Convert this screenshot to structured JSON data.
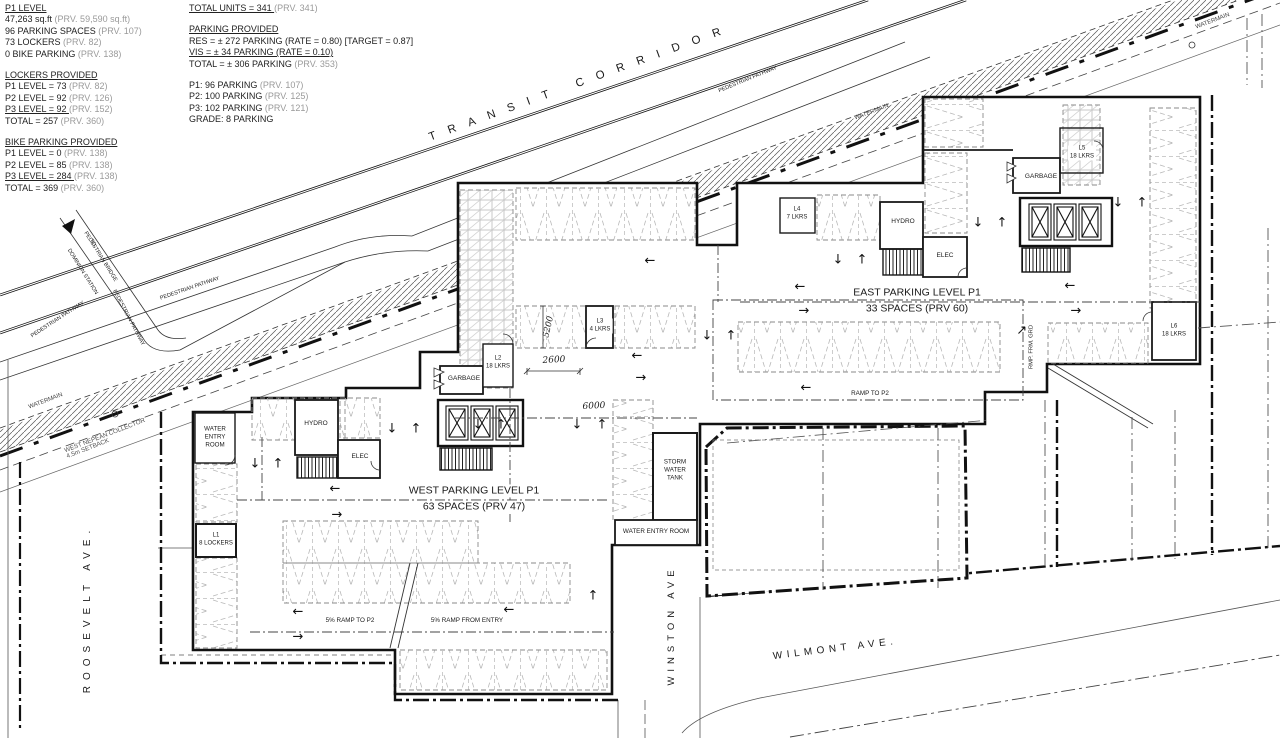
{
  "title_blocks": {
    "left": {
      "lines": [
        {
          "m": "P1 LEVEL",
          "u": true
        },
        {
          "m": "47,263 sq.ft ",
          "p": "(PRV. 59,590 sq.ft)"
        },
        {
          "m": "96 PARKING SPACES ",
          "p": "(PRV. 107)"
        },
        {
          "m": "73 LOCKERS ",
          "p": "(PRV. 82)"
        },
        {
          "m": "0 BIKE PARKING ",
          "p": "(PRV. 138)"
        },
        {
          "gap": true
        },
        {
          "m": "LOCKERS PROVIDED",
          "u": true
        },
        {
          "m": "P1 LEVEL = 73 ",
          "p": "(PRV. 82)"
        },
        {
          "m": "P2 LEVEL = 92 ",
          "p": "(PRV. 126)"
        },
        {
          "m": "P3 LEVEL = 92 ",
          "p": "(PRV. 152)",
          "u": true
        },
        {
          "m": "TOTAL = 257 ",
          "p": "(PRV. 360)"
        },
        {
          "gap": true
        },
        {
          "m": "BIKE PARKING PROVIDED",
          "u": true
        },
        {
          "m": "P1 LEVEL = 0 ",
          "p": "(PRV. 138)"
        },
        {
          "m": "P2 LEVEL = 85 ",
          "p": "(PRV. 138)"
        },
        {
          "m": "P3 LEVEL = 284 ",
          "p": "(PRV. 138)",
          "u": true
        },
        {
          "m": "TOTAL = 369 ",
          "p": "(PRV. 360)"
        }
      ]
    },
    "right": {
      "lines": [
        {
          "m": "TOTAL UNITS = 341 ",
          "p": "(PRV. 341)",
          "u": true
        },
        {
          "gap": true
        },
        {
          "m": "PARKING PROVIDED",
          "u": true
        },
        {
          "m": "RES = ± 272 PARKING (RATE = 0.80) [TARGET = 0.87]"
        },
        {
          "m": "VIS  =  ± 34  PARKING (RATE = 0.10)",
          "u": true
        },
        {
          "m": "TOTAL =  ± 306 PARKING ",
          "p": "(PRV. 353)"
        },
        {
          "gap": true
        },
        {
          "m": "P1: 96 PARKING ",
          "p": "(PRV. 107)"
        },
        {
          "m": "P2: 100 PARKING ",
          "p": "(PRV. 125)"
        },
        {
          "m": "P3: 102 PARKING ",
          "p": "(PRV. 121)"
        },
        {
          "m": "GRADE: 8 PARKING"
        }
      ]
    }
  },
  "plan": {
    "labels": [
      {
        "id": "transit-corridor-label",
        "t": "TRANSIT  CORRIDOR",
        "x": 575,
        "y": 85,
        "rot": -20,
        "fs": 11.5,
        "ls": 13
      },
      {
        "id": "pedestrian-pathway-label-1",
        "t": "PEDESTRIAN PATHWAY",
        "x": 190,
        "y": 289,
        "rot": -19,
        "fs": 5.5
      },
      {
        "id": "pedestrian-pathway-label-2",
        "t": "PEDESTRIAN PATHWAY",
        "x": 748,
        "y": 80,
        "rot": -22,
        "fs": 5.5
      },
      {
        "id": "pedestrian-pathway-label-3",
        "t": "PEDESTRIAN PATHWAY",
        "x": 128,
        "y": 318,
        "rot": 62,
        "fs": 5.5
      },
      {
        "id": "pedestrian-pathway-label-4",
        "t": "PEDESTRIAN PATHWAY",
        "x": 58,
        "y": 320,
        "rot": -33,
        "fs": 5.5
      },
      {
        "id": "pedestrian-bridge-label",
        "t": "PEDESTRIAN BRIDGE",
        "x": 100,
        "y": 257,
        "rot": 58,
        "fs": 5.5
      },
      {
        "id": "bridge-to-label",
        "t": "TO",
        "x": 92,
        "y": 243,
        "rot": 58,
        "fs": 5.5
      },
      {
        "id": "dominion-station-label",
        "t": "DOMINION STATION",
        "x": 82,
        "y": 272,
        "rot": 58,
        "fs": 5.5
      },
      {
        "id": "watermain-label-1",
        "t": "WATERMAIN",
        "x": 46,
        "y": 402,
        "rot": -21,
        "fs": 6,
        "c": "#444"
      },
      {
        "id": "watermain-label-2",
        "t": "WATERMAIN",
        "x": 872,
        "y": 113,
        "rot": -21,
        "fs": 6,
        "c": "#444"
      },
      {
        "id": "watermain-label-3",
        "t": "WATERMAIN",
        "x": 1213,
        "y": 22,
        "rot": -21,
        "fs": 6,
        "c": "#444"
      },
      {
        "id": "west-nepean-collector-label",
        "t": "WEST NEPEAN COLLECTOR",
        "x": 105,
        "y": 436,
        "rot": -21,
        "fs": 6.3,
        "c": "#555"
      },
      {
        "id": "setback-label",
        "t": "4.5m SETBACK",
        "x": 88,
        "y": 449,
        "rot": -21,
        "fs": 6.3,
        "c": "#555"
      },
      {
        "id": "roosevelt-ave-label",
        "t": "ROOSEVELT AVE.",
        "x": 88,
        "y": 612,
        "rot": -90,
        "fs": 10,
        "ls": 6
      },
      {
        "id": "winston-ave-label",
        "t": "WINSTON AVE",
        "x": 672,
        "y": 628,
        "rot": -90,
        "fs": 9.5,
        "ls": 5
      },
      {
        "id": "wilmont-ave-label",
        "t": "WILMONT AVE.",
        "x": 833,
        "y": 650,
        "rot": -7,
        "fs": 10,
        "ls": 4.5
      },
      {
        "id": "west-parking-title",
        "t": "WEST PARKING LEVEL P1",
        "x": 474,
        "y": 491,
        "fs": 10.5,
        "bg": 1
      },
      {
        "id": "west-parking-count",
        "t": "63 SPACES (PRV 47)",
        "x": 474,
        "y": 507,
        "fs": 10.5,
        "bg": 1
      },
      {
        "id": "east-parking-title",
        "t": "EAST PARKING LEVEL P1",
        "x": 917,
        "y": 293,
        "fs": 10.5,
        "bg": 1
      },
      {
        "id": "east-parking-count",
        "t": "33 SPACES (PRV 60)",
        "x": 917,
        "y": 309,
        "fs": 10.5,
        "bg": 1
      },
      {
        "id": "ramp-to-p2-label",
        "t": "RAMP TO P2",
        "x": 870,
        "y": 394,
        "fs": 6.3
      },
      {
        "id": "ramp-5pct-to-p2-label",
        "t": "5% RAMP TO P2",
        "x": 350,
        "y": 621,
        "fs": 6.3
      },
      {
        "id": "ramp-5pct-from-entry-label",
        "t": "5% RAMP FROM ENTRY",
        "x": 467,
        "y": 621,
        "fs": 6.3
      },
      {
        "id": "ramp-from-grade-label",
        "t": "RMP. FRM. GRD",
        "x": 1032,
        "y": 347,
        "rot": -90,
        "fs": 5.8
      },
      {
        "id": "water-entry-room-west-label",
        "t": "WATER\nENTRY\nROOM",
        "x": 215,
        "y": 437,
        "fs": 6.2
      },
      {
        "id": "hydro-west-label",
        "t": "HYDRO",
        "x": 316,
        "y": 424,
        "fs": 6.5
      },
      {
        "id": "elec-west-label",
        "t": "ELEC",
        "x": 360,
        "y": 457,
        "fs": 6.5
      },
      {
        "id": "garbage-west-label",
        "t": "GARBAGE",
        "x": 464,
        "y": 379,
        "fs": 6.5,
        "bg": 1
      },
      {
        "id": "l1-lockers-label",
        "t": "L1\n8 LOCKERS",
        "x": 216,
        "y": 540,
        "fs": 6
      },
      {
        "id": "l2-lockers-label",
        "t": "L2\n18 LKRS",
        "x": 498,
        "y": 363,
        "fs": 6,
        "bg": 1
      },
      {
        "id": "l3-lockers-label",
        "t": "L3\n4 LKRS",
        "x": 600,
        "y": 326,
        "fs": 6,
        "bg": 1
      },
      {
        "id": "l4-lockers-label",
        "t": "L4\n7 LKRS",
        "x": 797,
        "y": 214,
        "fs": 6,
        "bg": 1
      },
      {
        "id": "hydro-east-label",
        "t": "HYDRO",
        "x": 903,
        "y": 222,
        "fs": 6.5
      },
      {
        "id": "elec-east-label",
        "t": "ELEC",
        "x": 945,
        "y": 256,
        "fs": 6.5
      },
      {
        "id": "garbage-east-label",
        "t": "GARBAGE",
        "x": 1041,
        "y": 177,
        "fs": 6.5,
        "bg": 1
      },
      {
        "id": "l5-lockers-label",
        "t": "L5\n18 LKRS",
        "x": 1082,
        "y": 153,
        "fs": 6,
        "bg": 1
      },
      {
        "id": "l6-lockers-label",
        "t": "L6\n18 LKRS",
        "x": 1174,
        "y": 331,
        "fs": 6,
        "bg": 1
      },
      {
        "id": "storm-water-tank-label",
        "t": "STORM\nWATER\nTANK",
        "x": 675,
        "y": 470,
        "fs": 6.2
      },
      {
        "id": "water-entry-room-south-label",
        "t": "WATER ENTRY ROOM",
        "x": 656,
        "y": 532,
        "fs": 6.3,
        "bg": 1
      },
      {
        "id": "dim-5200",
        "t": "5200",
        "x": 549,
        "y": 327,
        "rot": -77,
        "fs": 8.5,
        "it": 1
      },
      {
        "id": "dim-2600",
        "t": "2600",
        "x": 554,
        "y": 361,
        "rot": -3,
        "fs": 9,
        "it": 1
      },
      {
        "id": "dim-6000",
        "t": "6000",
        "x": 594,
        "y": 407,
        "rot": -3,
        "fs": 9,
        "it": 1
      }
    ],
    "arrows": [
      {
        "g": "←",
        "x": 335,
        "y": 489
      },
      {
        "g": "→",
        "x": 337,
        "y": 515
      },
      {
        "g": "↓",
        "x": 255,
        "y": 464
      },
      {
        "g": "↑",
        "x": 278,
        "y": 464
      },
      {
        "g": "↓",
        "x": 392,
        "y": 429
      },
      {
        "g": "↑",
        "x": 416,
        "y": 429
      },
      {
        "g": "↓",
        "x": 478,
        "y": 425
      },
      {
        "g": "↑",
        "x": 501,
        "y": 425
      },
      {
        "g": "↓",
        "x": 577,
        "y": 425
      },
      {
        "g": "↑",
        "x": 602,
        "y": 425
      },
      {
        "g": "←",
        "x": 637,
        "y": 356
      },
      {
        "g": "→",
        "x": 641,
        "y": 378
      },
      {
        "g": "←",
        "x": 650,
        "y": 261
      },
      {
        "g": "↓",
        "x": 707,
        "y": 336
      },
      {
        "g": "↑",
        "x": 731,
        "y": 336
      },
      {
        "g": "←",
        "x": 298,
        "y": 612
      },
      {
        "g": "→",
        "x": 298,
        "y": 637
      },
      {
        "g": "←",
        "x": 509,
        "y": 610
      },
      {
        "g": "↑",
        "x": 593,
        "y": 596
      },
      {
        "g": "←",
        "x": 800,
        "y": 287
      },
      {
        "g": "→",
        "x": 804,
        "y": 311
      },
      {
        "g": "↓",
        "x": 838,
        "y": 260
      },
      {
        "g": "↑",
        "x": 862,
        "y": 260
      },
      {
        "g": "↓",
        "x": 978,
        "y": 223
      },
      {
        "g": "↑",
        "x": 1002,
        "y": 223
      },
      {
        "g": "↓",
        "x": 1118,
        "y": 203
      },
      {
        "g": "↑",
        "x": 1142,
        "y": 203
      },
      {
        "g": "←",
        "x": 1070,
        "y": 286
      },
      {
        "g": "→",
        "x": 1076,
        "y": 311
      },
      {
        "g": "←",
        "x": 806,
        "y": 388
      },
      {
        "g": "↑",
        "x": 1021,
        "y": 331,
        "rot": 45
      }
    ]
  }
}
